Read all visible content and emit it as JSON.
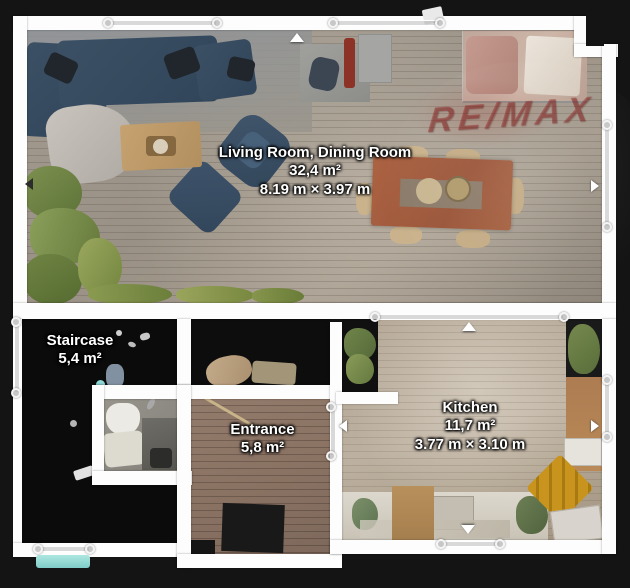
{
  "watermark": {
    "text": "RE/MAX",
    "color": "#94221e"
  },
  "colors": {
    "background": "#141414",
    "wall": "#fdfdfd",
    "label_text": "#ffffff",
    "sofa_navy": "#35495c",
    "dining_table": "#a05a3c",
    "teal_mat": "#8fd8d4",
    "gold_cabinet": "#c8941e",
    "plant_green": "#6d8245",
    "red_chair": "#8c3226"
  },
  "rooms": {
    "living": {
      "name": "Living Room, Dining Room",
      "area": "32,4 m²",
      "dimensions": "8.19 m × 3.97 m"
    },
    "staircase": {
      "name": "Staircase",
      "area": "5,4 m²"
    },
    "entrance": {
      "name": "Entrance",
      "area": "5,8 m²"
    },
    "kitchen": {
      "name": "Kitchen",
      "area": "11,7 m²",
      "dimensions": "3.77 m × 3.10 m"
    }
  }
}
